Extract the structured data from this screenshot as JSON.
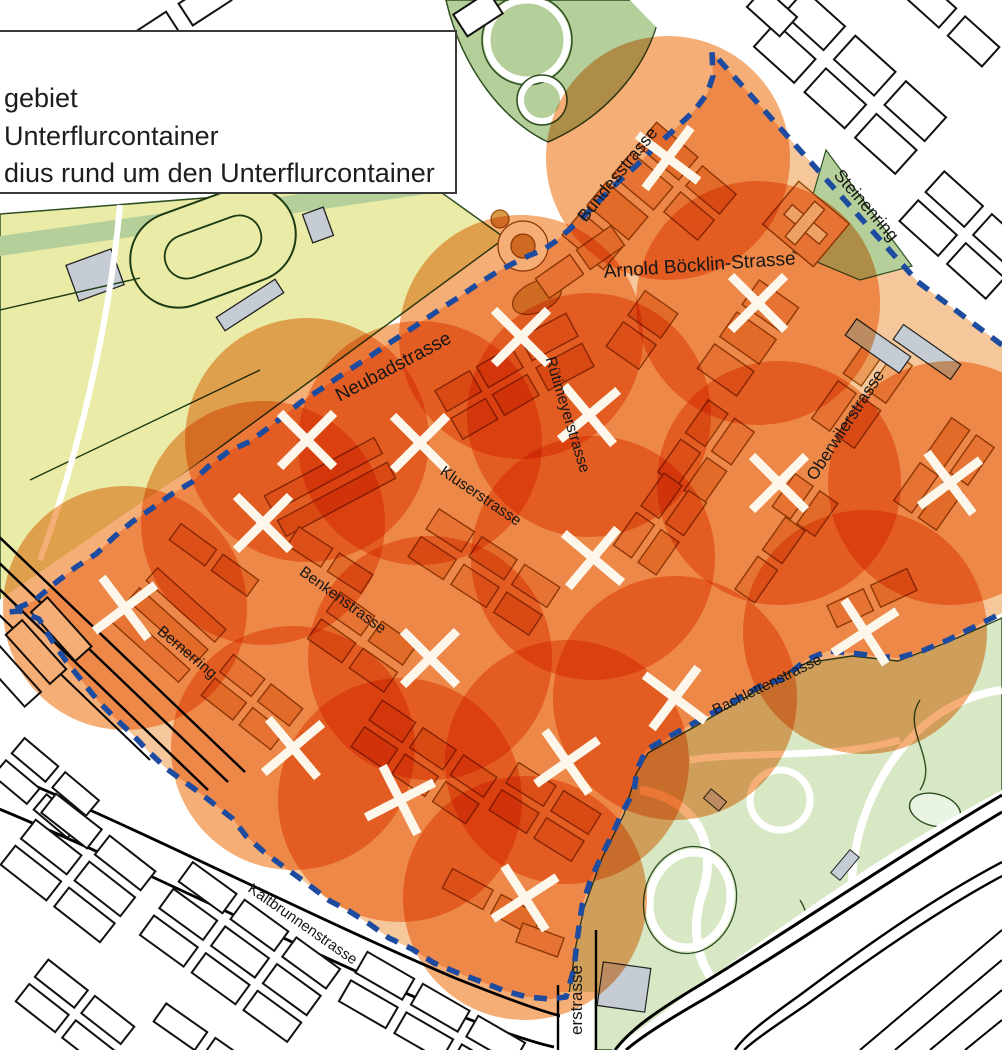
{
  "legend": {
    "items": [
      {
        "id": "district-area",
        "label": "gebiet"
      },
      {
        "id": "container-location",
        "label": "Unterflurcontainer"
      },
      {
        "id": "container-radius",
        "label": "dius rund um den Unterflurcontainer"
      }
    ]
  },
  "map": {
    "street_labels": [
      {
        "text": "Bundesstrasse",
        "x": 622,
        "y": 178,
        "rot": -51,
        "size": 17.5
      },
      {
        "text": "Steinenring",
        "x": 862,
        "y": 209,
        "rot": 49,
        "size": 17.5
      },
      {
        "text": "Arnold Böcklin-Strasse",
        "x": 700,
        "y": 271,
        "rot": -4,
        "size": 19
      },
      {
        "text": "Neubadstrasse",
        "x": 396,
        "y": 372,
        "rot": -28,
        "size": 19
      },
      {
        "text": "Rütimeyerstrasse",
        "x": 563,
        "y": 416,
        "rot": 73,
        "size": 15.5
      },
      {
        "text": "Oberwilerstrasse",
        "x": 850,
        "y": 428,
        "rot": -57,
        "size": 17
      },
      {
        "text": "Kluserstrasse",
        "x": 478,
        "y": 500,
        "rot": 34,
        "size": 15.5
      },
      {
        "text": "Benkenstrasse",
        "x": 340,
        "y": 604,
        "rot": 36,
        "size": 15.5
      },
      {
        "text": "Bernerring",
        "x": 184,
        "y": 656,
        "rot": 40,
        "size": 15.5
      },
      {
        "text": "Bachlettenstrasse",
        "x": 769,
        "y": 689,
        "rot": -26,
        "size": 15
      },
      {
        "text": "Kaltbrunnenstrasse",
        "x": 300,
        "y": 928,
        "rot": 35,
        "size": 15
      },
      {
        "text": "erstrasse",
        "x": 582,
        "y": 1000,
        "rot": -90,
        "size": 17
      }
    ],
    "container_markers": [
      [
        668,
        158,
        -8
      ],
      [
        758,
        303,
        0
      ],
      [
        521,
        337,
        0
      ],
      [
        589,
        415,
        5
      ],
      [
        307,
        440,
        0
      ],
      [
        420,
        443,
        0
      ],
      [
        779,
        483,
        0
      ],
      [
        950,
        483,
        8
      ],
      [
        263,
        523,
        0
      ],
      [
        593,
        558,
        -5
      ],
      [
        125,
        608,
        8
      ],
      [
        865,
        632,
        12
      ],
      [
        430,
        658,
        0
      ],
      [
        675,
        698,
        -8
      ],
      [
        293,
        748,
        5
      ],
      [
        567,
        762,
        10
      ],
      [
        400,
        800,
        18
      ],
      [
        525,
        898,
        12
      ]
    ],
    "coverage_radius_px": 122,
    "colors": {
      "district_base": "#f7c79c",
      "district_building": "#f0a86d",
      "district_building_alt": "#ec9c5a",
      "district_building_outline": "#94500c",
      "coverage_circle": "#f5ae76",
      "boundary_dash": "#1c4ba0",
      "marker": "#fcf7ea",
      "park_yellow": "#e9eba6",
      "park_green": "#b5cf9b",
      "zoo_green": "#d8e8c4",
      "map_outline": "#111111",
      "gray_building": "#c5ccd3"
    }
  }
}
